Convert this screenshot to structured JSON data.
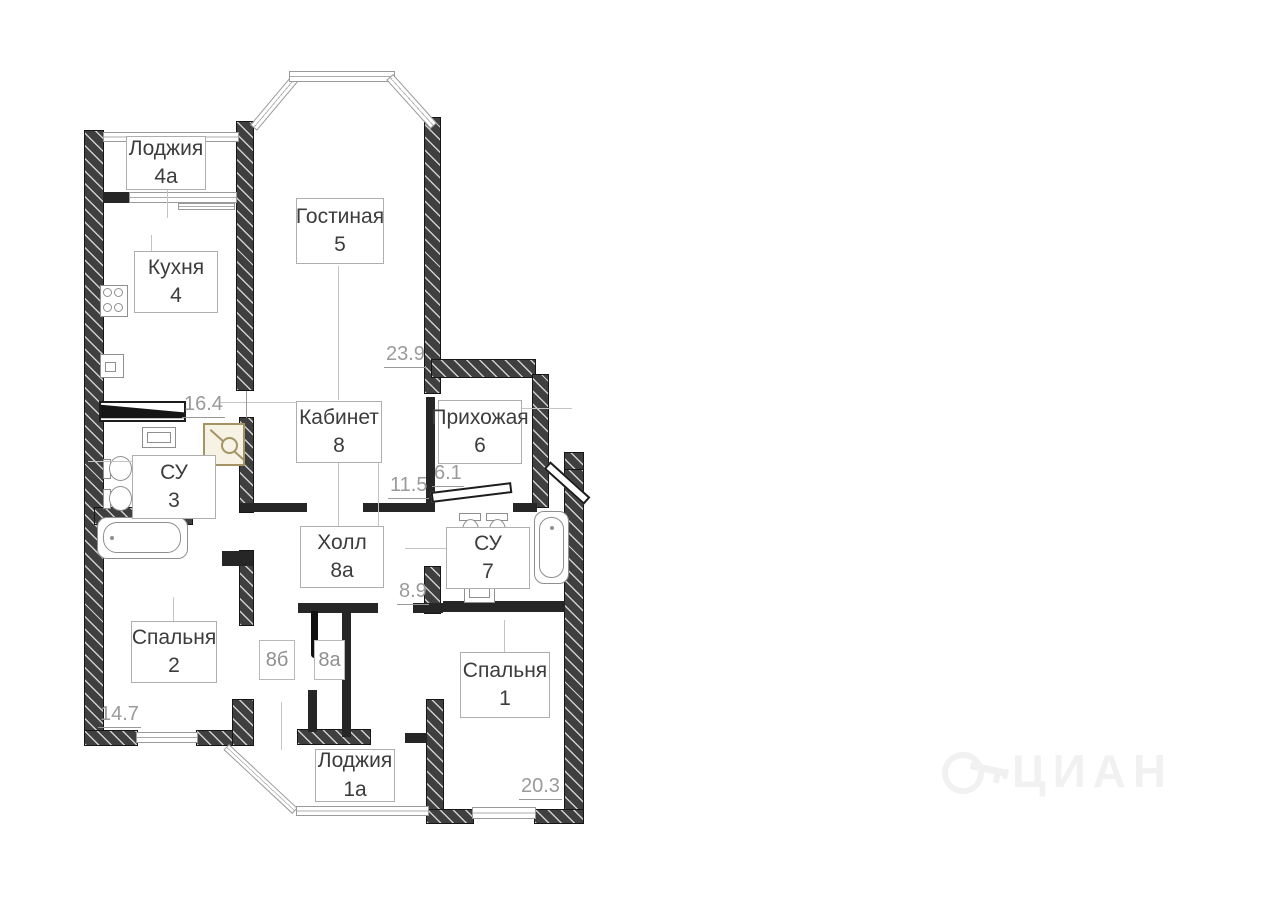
{
  "rooms": {
    "loggia4a": {
      "name": "Лоджия",
      "num": "4а"
    },
    "kitchen": {
      "name": "Кухня",
      "num": "4"
    },
    "living": {
      "name": "Гостиная",
      "num": "5"
    },
    "study": {
      "name": "Кабинет",
      "num": "8"
    },
    "hallway": {
      "name": "Прихожая",
      "num": "6"
    },
    "wc3": {
      "name": "СУ",
      "num": "3"
    },
    "hall8a": {
      "name": "Холл",
      "num": "8а"
    },
    "wc7": {
      "name": "СУ",
      "num": "7"
    },
    "bedroom2": {
      "name": "Спальня",
      "num": "2"
    },
    "bedroom1": {
      "name": "Спальня",
      "num": "1"
    },
    "loggia1a": {
      "name": "Лоджия",
      "num": "1а"
    },
    "closet8b": {
      "num": "8б"
    },
    "closet8a": {
      "num": "8а"
    }
  },
  "dims": {
    "living": "23.9",
    "kitchen": "16.4",
    "study": "11.5",
    "hallway": "6.1",
    "hall": "8.9",
    "bedroom2": "14.7",
    "bedroom1": "20.3"
  },
  "watermark": "ЦИАН",
  "colors": {
    "wall": "#3f3f3f",
    "dimension_text": "#9a9a9a",
    "label_text": "#3c3c3c",
    "label_border": "#aeaeae",
    "shower_accent": "#a59366",
    "background": "#ffffff"
  }
}
